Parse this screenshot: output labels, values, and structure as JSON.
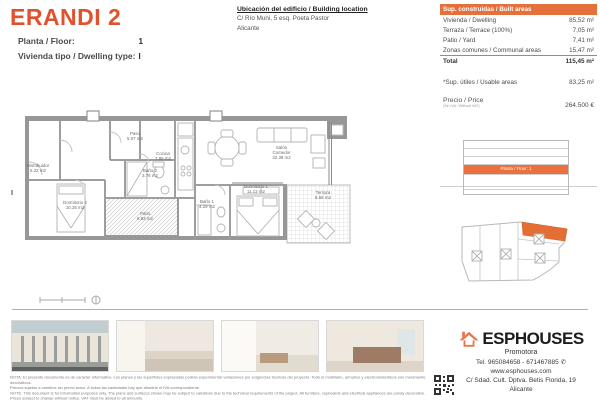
{
  "header": {
    "title": "ERANDI 2",
    "floor_label": "Planta / Floor:",
    "floor_value": "1",
    "type_label": "Vivienda tipo / Dwelling type:",
    "type_value": "I"
  },
  "location": {
    "title": "Ubicación del edificio / Building location",
    "line1": "C/ Río Muni, 5 esq. Poeta Pastor",
    "line2": "Alicante"
  },
  "built_areas": {
    "header": "Sup. construidas / Built areas",
    "rows": [
      {
        "label": "Vivienda / Dwelling",
        "value": "85,52 m²"
      },
      {
        "label": "Terraza / Terrace (100%)",
        "value": "7,05 m²"
      },
      {
        "label": "Patio / Yard",
        "value": "7,41 m²"
      },
      {
        "label": "Zonas comunes / Communal areas",
        "value": "15,47 m²"
      }
    ],
    "total_label": "Total",
    "total_value": "115,45 m²"
  },
  "usable": {
    "label": "*Sup. útiles / Usable areas",
    "value": "83,25 m²"
  },
  "price": {
    "label": "Precio / Price",
    "sublabel": "(Sin IVA / Without VAT)",
    "value": "264.500 €"
  },
  "elevation": {
    "highlight_label": "Planta / Floor: 1"
  },
  "plan": {
    "unit_letter": "I",
    "rooms": [
      {
        "name": "Distribuidor",
        "area": "5.22 m2"
      },
      {
        "name": "Paso",
        "area": "5.07 m2"
      },
      {
        "name": "Baño 2",
        "area": "3.76 m2"
      },
      {
        "name": "Cocina",
        "area": "7.85 m2"
      },
      {
        "name": "Salón Comedor",
        "area": "22.38 m2"
      },
      {
        "name": "Dormitorio 1",
        "area": "11.12 m2"
      },
      {
        "name": "Dormitorio 2",
        "area": "10.25 m2"
      },
      {
        "name": "Baño 1",
        "area": "4.29 m2"
      },
      {
        "name": "Patio",
        "area": "6.83 m2"
      },
      {
        "name": "Terraza",
        "area": "8.58 m2"
      }
    ]
  },
  "photos": [
    {
      "name": "building-exterior-render"
    },
    {
      "name": "living-room-render"
    },
    {
      "name": "kitchen-dining-render"
    },
    {
      "name": "bedroom-render"
    }
  ],
  "footer": {
    "brand": "ESPHOUSES",
    "brand_sub": "Promotora",
    "tel": "Tel. 965084658 - 671467885",
    "web": "www.esphouses.com",
    "address": "C/ Sdad. Cult. Dptva. Betis Florida, 19",
    "city": "Alicante",
    "legal": [
      "NOTA: El presente documento es de carácter informativo. Los planos y las superficies expresadas podrán experimentar variaciones por exigencias técnicas del proyecto. Todo el mobiliario, armarios y electrodomésticos son meramente decorativos.",
      "Precios sujetos a cambios sin previo aviso. A todas las cantidades hay que añadirle el IVA correspondiente.",
      "NOTE: This document is for information purposes only. The plans and surfaces shown may be subject to variations due to the technical requirements of the project. All furniture, cupboards and electrical appliances are purely decorative.",
      "Prices subject to change without notice. VAT must be added to all amounts."
    ]
  },
  "colors": {
    "accent": "#E0512D",
    "table_header": "#E4703C",
    "elevation_highlight": "#EC6F3E",
    "siteplan_fill": "#E46E33"
  }
}
